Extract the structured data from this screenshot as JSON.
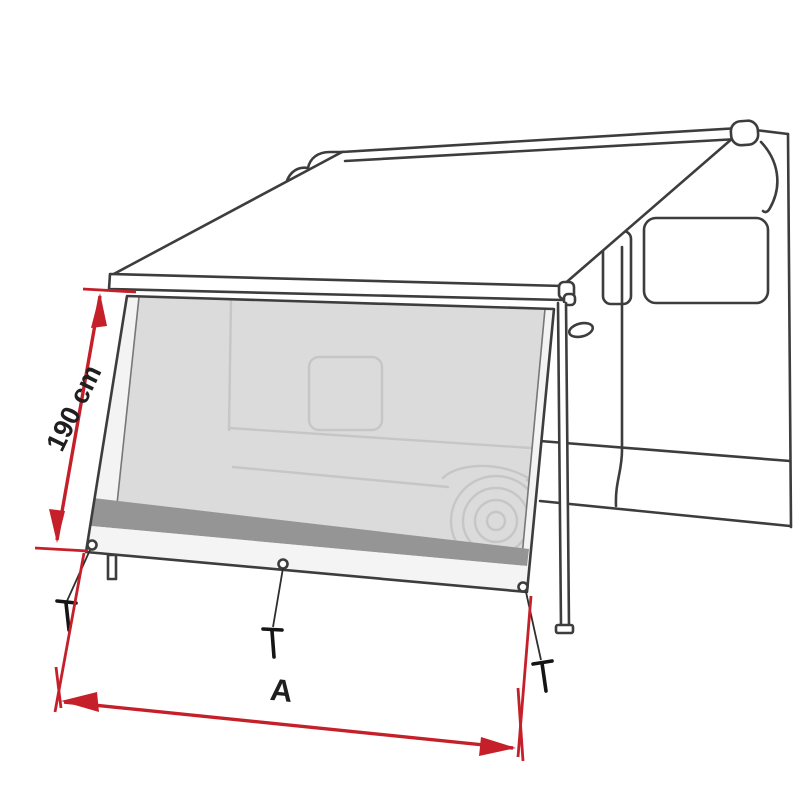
{
  "diagram": {
    "title": "Awning front side-panel dimension drawing",
    "type": "technical-line-drawing",
    "subject": "Campervan with wind-out awning and front sun-view panel mounted between lead bar and ground",
    "dimensions": {
      "height_label": "190 cm",
      "width_label": "A"
    },
    "icons": [
      "tent-peg-icon",
      "grommet-icon",
      "pull-strap-icon"
    ],
    "colors": {
      "accent_red": "#c5202a",
      "outline": "#3d3d3d",
      "panel_mesh": "#dbdbdb",
      "panel_band": "#959595",
      "panel_hem": "#f3f3f3",
      "panel_strip": "#f4f4f4",
      "sketch_faint": "#c6c6c6",
      "background": "#ffffff",
      "peg_black": "#151515",
      "label_ink": "#1f1f1f"
    }
  }
}
